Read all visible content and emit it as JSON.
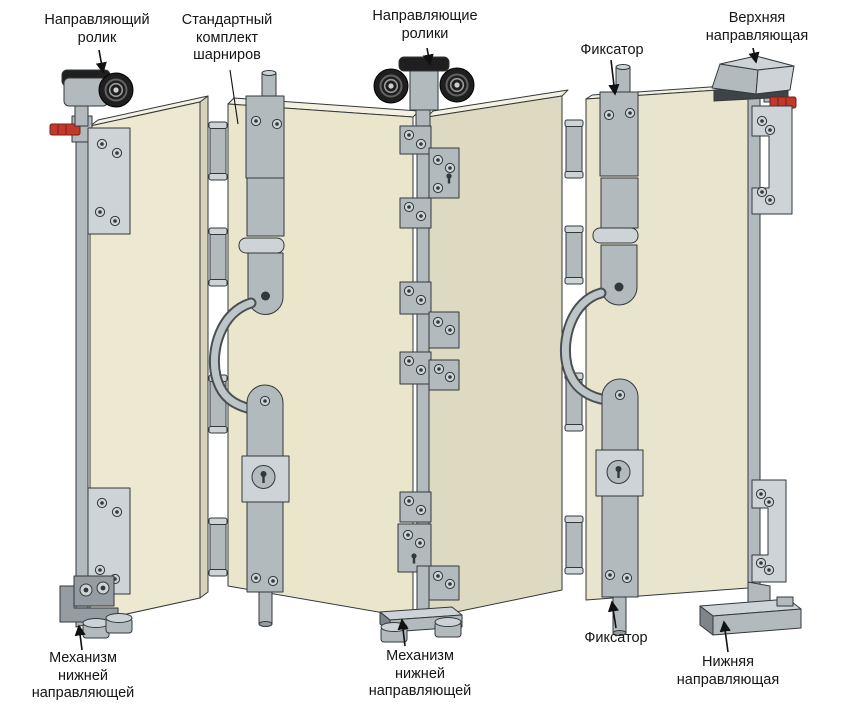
{
  "labels": {
    "guide_roller": "Направляющий\nролик",
    "standard_hinge_kit": "Стандартный\nкомплект\nшарниров",
    "guide_rollers": "Направляющие\nролики",
    "fixator_top": "Фиксатор",
    "upper_guide": "Верхняя\nнаправляющая",
    "lower_guide_mechanism_left": "Механизм\nнижней\nнаправляющей",
    "lower_guide_mechanism_center": "Механизм\nнижней\nнаправляющей",
    "fixator_bottom": "Фиксатор",
    "lower_guide": "Нижняя\nнаправляющая"
  },
  "colors": {
    "bg": "#ffffff",
    "ink": "#151515",
    "line": "#33383b",
    "panel1": "#ece8d2",
    "panel2": "#eae6cc",
    "panel3": "#dedac2",
    "panel4": "#e8e4cd",
    "paneltop": "#f4f1e1",
    "panelside": "#d7d3ba",
    "metal": "#b3babe",
    "metallight": "#cdd3d6",
    "metaldark": "#969da2",
    "metaldeep": "#7e858a",
    "roller": "#1f1f1f",
    "red": "#c0392b"
  }
}
